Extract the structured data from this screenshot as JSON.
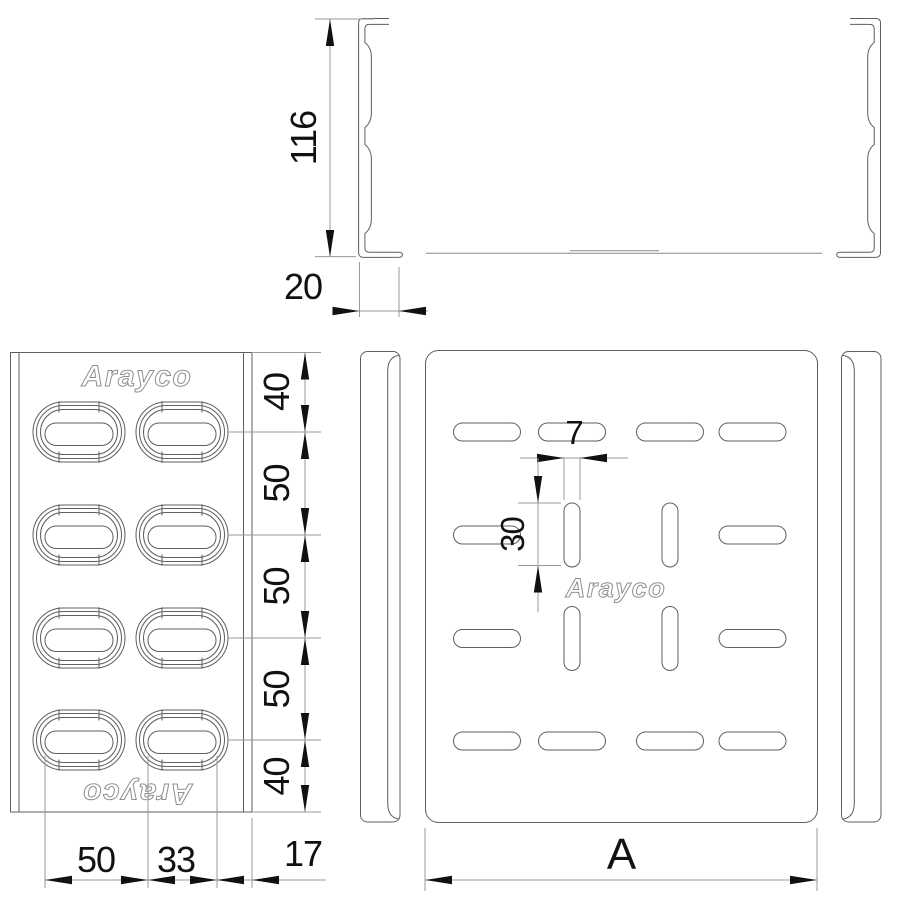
{
  "brand": {
    "logo_text": "Arayco"
  },
  "dimensions": {
    "section": {
      "height": "116",
      "flange": "20"
    },
    "side_view": {
      "vertical_chain": [
        "40",
        "50",
        "50",
        "50",
        "40"
      ],
      "horizontal_chain": [
        "50",
        "33",
        "17"
      ]
    },
    "plan_view": {
      "slot_width": "7",
      "slot_length": "30",
      "overall_width": "A"
    }
  },
  "colors": {
    "background": "#ffffff",
    "outline": "#5f5f5f",
    "outline_light": "#8a8a8a",
    "dim_line": "#9a9a9a",
    "annotation": "#111111",
    "logo_outline": "#8f8f8f"
  }
}
